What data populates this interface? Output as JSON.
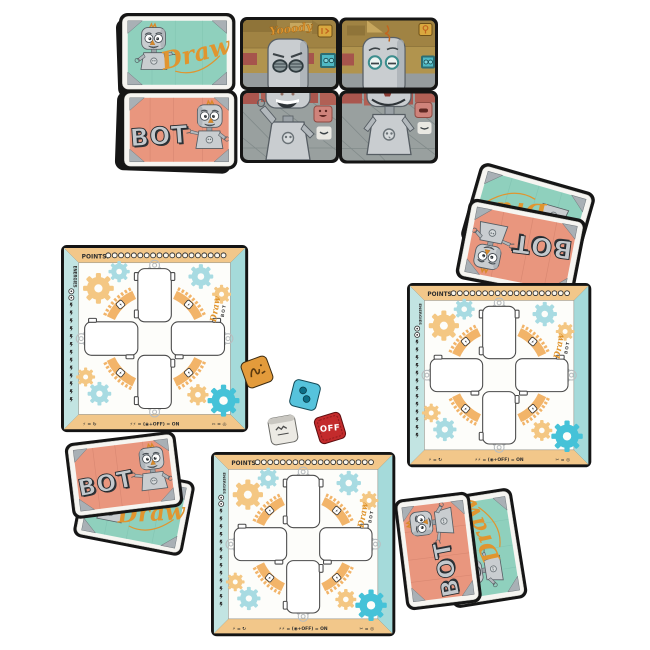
{
  "scene": {
    "background_color": "#ffffff",
    "description": "Draw BOT board game components laid out on white"
  },
  "cards": {
    "draw_label": "Draw",
    "bot_label": "BOT"
  },
  "scene_cards": {
    "graffiti": "Yooody"
  },
  "board": {
    "points_label": "POINTS:",
    "points_slots": 19,
    "energies_label": "ENERGIES",
    "energy_ticks": 13,
    "logo_draw": "Draw",
    "logo_bot": "BOT",
    "legend_energy_rotate": "⚡ = ↻",
    "legend_energy_onoff": "⚡⚡ = (◉+OFF) = ON",
    "legend_break": "✂ = ◎"
  },
  "dice": {
    "red_face_label": "OFF"
  },
  "colors": {
    "card_teal": "#8fd0bd",
    "card_salmon": "#e9967e",
    "accent_orange": "#e0952f",
    "board_tan": "#f2c78a",
    "board_teal": "#a5dada",
    "board_teal_light": "#c2e4e2",
    "gear_orange": "#f4c783",
    "gear_teal": "#a8dbe2",
    "gear_cyan": "#45c2d8",
    "arc_orange": "#f2b469",
    "die_orange": "#e39b3b",
    "die_cyan": "#56c3dc",
    "die_white": "#eceae4",
    "die_red": "#c32b2c",
    "robot_gray": "#c9cdd0",
    "scene_olive": "#b1944e",
    "scene_floor_gray": "#99a09f"
  }
}
